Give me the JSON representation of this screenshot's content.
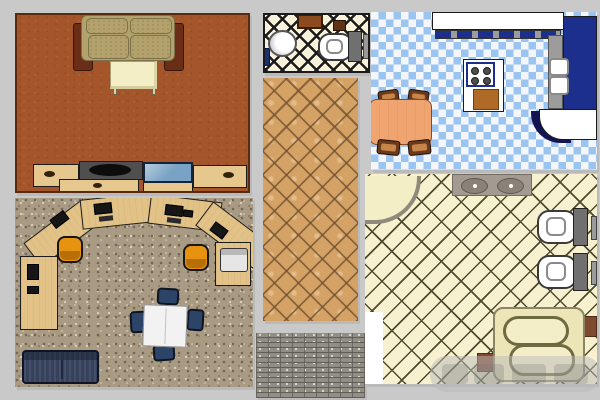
{
  "canvas": {
    "width": 600,
    "height": 400,
    "description": "Collage of top-down 3D interior renders and two texture swatches on a gray background"
  },
  "watermark": {
    "present": true,
    "text_legible": false
  },
  "panels": [
    {
      "id": "living-room",
      "type": "room-top-view",
      "name": "Living room",
      "floor": "terracotta",
      "furniture": [
        "two-seat fabric sofa with dark side throws",
        "ivory coffee table",
        "media console with speakers, drawer and blue TV screen"
      ]
    },
    {
      "id": "small-bathroom",
      "type": "room-top-view",
      "name": "Small bathroom",
      "floor": "cream tile with black diagonal lattice",
      "furniture": [
        "brown wall cabinet",
        "small brown hamper",
        "white pedestal sink",
        "toilet with gray tank and flush bar"
      ]
    },
    {
      "id": "kitchen",
      "type": "room-top-view",
      "name": "Kitchen",
      "floor": "light blue and white checkerboard",
      "furniture": [
        "white counter run",
        "navy cabinet strip",
        "navy tall cabinet column",
        "stacked white wall ovens",
        "curved end counter",
        "island with four-burner cooktop",
        "cutting board",
        "orange dining table",
        "four brown chairs"
      ]
    },
    {
      "id": "tan-tile-swatch",
      "type": "texture-swatch",
      "name": "Tan diagonal tile texture"
    },
    {
      "id": "office",
      "type": "room-top-view",
      "name": "Office",
      "floor": "speckled carpet",
      "furniture": [
        "curved run of wood desks",
        "black monitors and keyboards",
        "two orange task chairs",
        "printer on end desk",
        "white meeting table",
        "four navy chairs",
        "navy two-seat sofa"
      ]
    },
    {
      "id": "brick-swatch",
      "type": "texture-swatch",
      "name": "Gray brick texture"
    },
    {
      "id": "large-bathroom",
      "type": "room-top-view",
      "name": "Large bathroom",
      "floor": "cream diagonal brick tile",
      "furniture": [
        "corner tub",
        "gray double-sink vanity",
        "two toilets with tanks and flush bars",
        "spa tub on platform with wood deck strips"
      ]
    }
  ],
  "colors": {
    "bg": "#c9c9c9",
    "living-floor": "#a5552a",
    "living-border": "#5a2a10",
    "sofa-fabric": "#b3a26b",
    "sofa-cushion-line": "#7d714a",
    "sofa-throw": "#6a2e16",
    "ivory": "#f4eec6",
    "wood-tan": "#e6c78d",
    "console-dark": "#4f4f4f",
    "screen-blue": "#79a3c4",
    "outline": "#1b1b1b",
    "bath-cream": "#f8f2da",
    "cabinet-brown": "#8c4a1f",
    "box-brown": "#5e3316",
    "fixture-gray": "#707070",
    "bar-gray": "#9a9a9a",
    "kitchen-blue": "#9cc4f0",
    "kitchen-white": "#f3f6fb",
    "counter-white": "#ffffff",
    "navy": "#1c2f8c",
    "navy-dark": "#141452",
    "appliance-gray": "#9c9c9c",
    "board-brown": "#b06a28",
    "burner": "#4e4e4e",
    "table-orange": "#f0a571",
    "chair-brown": "#6b3a1a",
    "carpet": "#a99a84",
    "desk-wood": "#e2c286",
    "monitor-black": "#161616",
    "chair-orange": "#e8930f",
    "meeting-white": "#f2f2f2",
    "chair-navy": "#2c4468",
    "sofa-navy": "#36415c",
    "tile-tan": "#d5a266",
    "tile-line": "#745432cc",
    "brick-gray": "#908e86",
    "brick-line": "#5f5d56",
    "bath2-cream": "#f7f1cf",
    "bath2-line": "#4e4a30",
    "granite": "#a39b91",
    "basin": "#8a8178",
    "tub-cream": "#ece5b8",
    "tub-line": "#6e6a40",
    "deck-brown": "#7e4a30"
  }
}
